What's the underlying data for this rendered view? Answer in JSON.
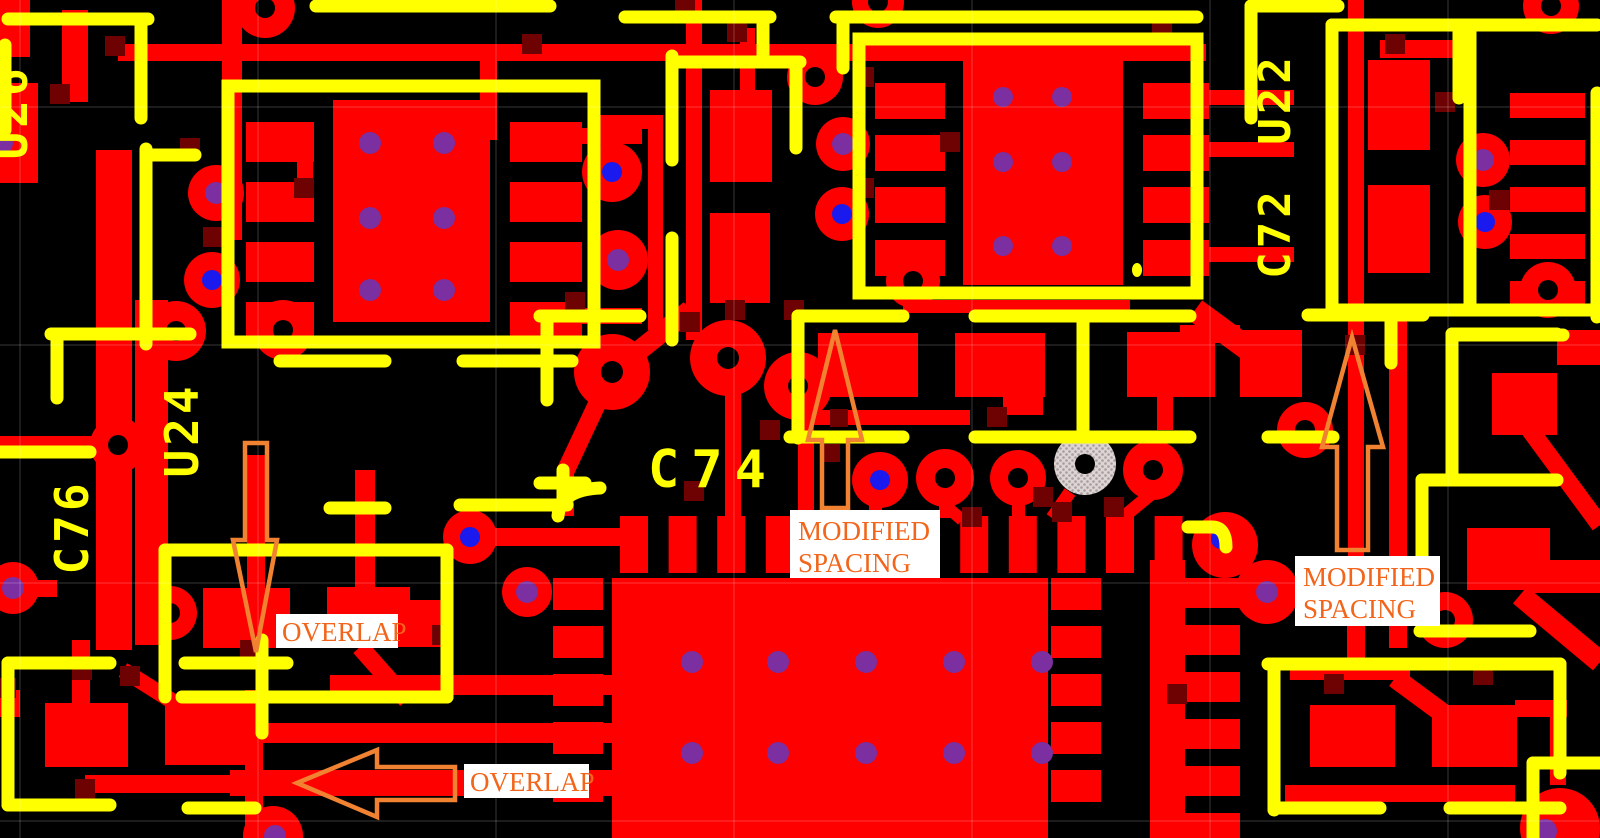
{
  "designators": {
    "u26": "U26",
    "c76": "C76",
    "u24": "U24",
    "c74": "C74",
    "c72": "C72",
    "u22": "U22"
  },
  "annotations": {
    "modified_spacing_1": {
      "line1": "MODIFIED",
      "line2": "SPACING"
    },
    "modified_spacing_2": {
      "line1": "MODIFIED",
      "line2": "SPACING"
    },
    "overlap_1": {
      "label": "OVERLAP"
    },
    "overlap_2": {
      "label": "OVERLAP"
    }
  },
  "colors": {
    "board_background": "#000000",
    "copper": "#fe0000",
    "silkscreen": "#ffff00",
    "junction_dark_red": "#6e0202",
    "via_purple": "#7b2fa0",
    "via_blue": "#1a1aee",
    "free_pad_gray": "#d8cfcf",
    "annotation_text": "#f2651a",
    "annotation_arrow": "#f08232",
    "annotation_background": "#ffffff"
  }
}
